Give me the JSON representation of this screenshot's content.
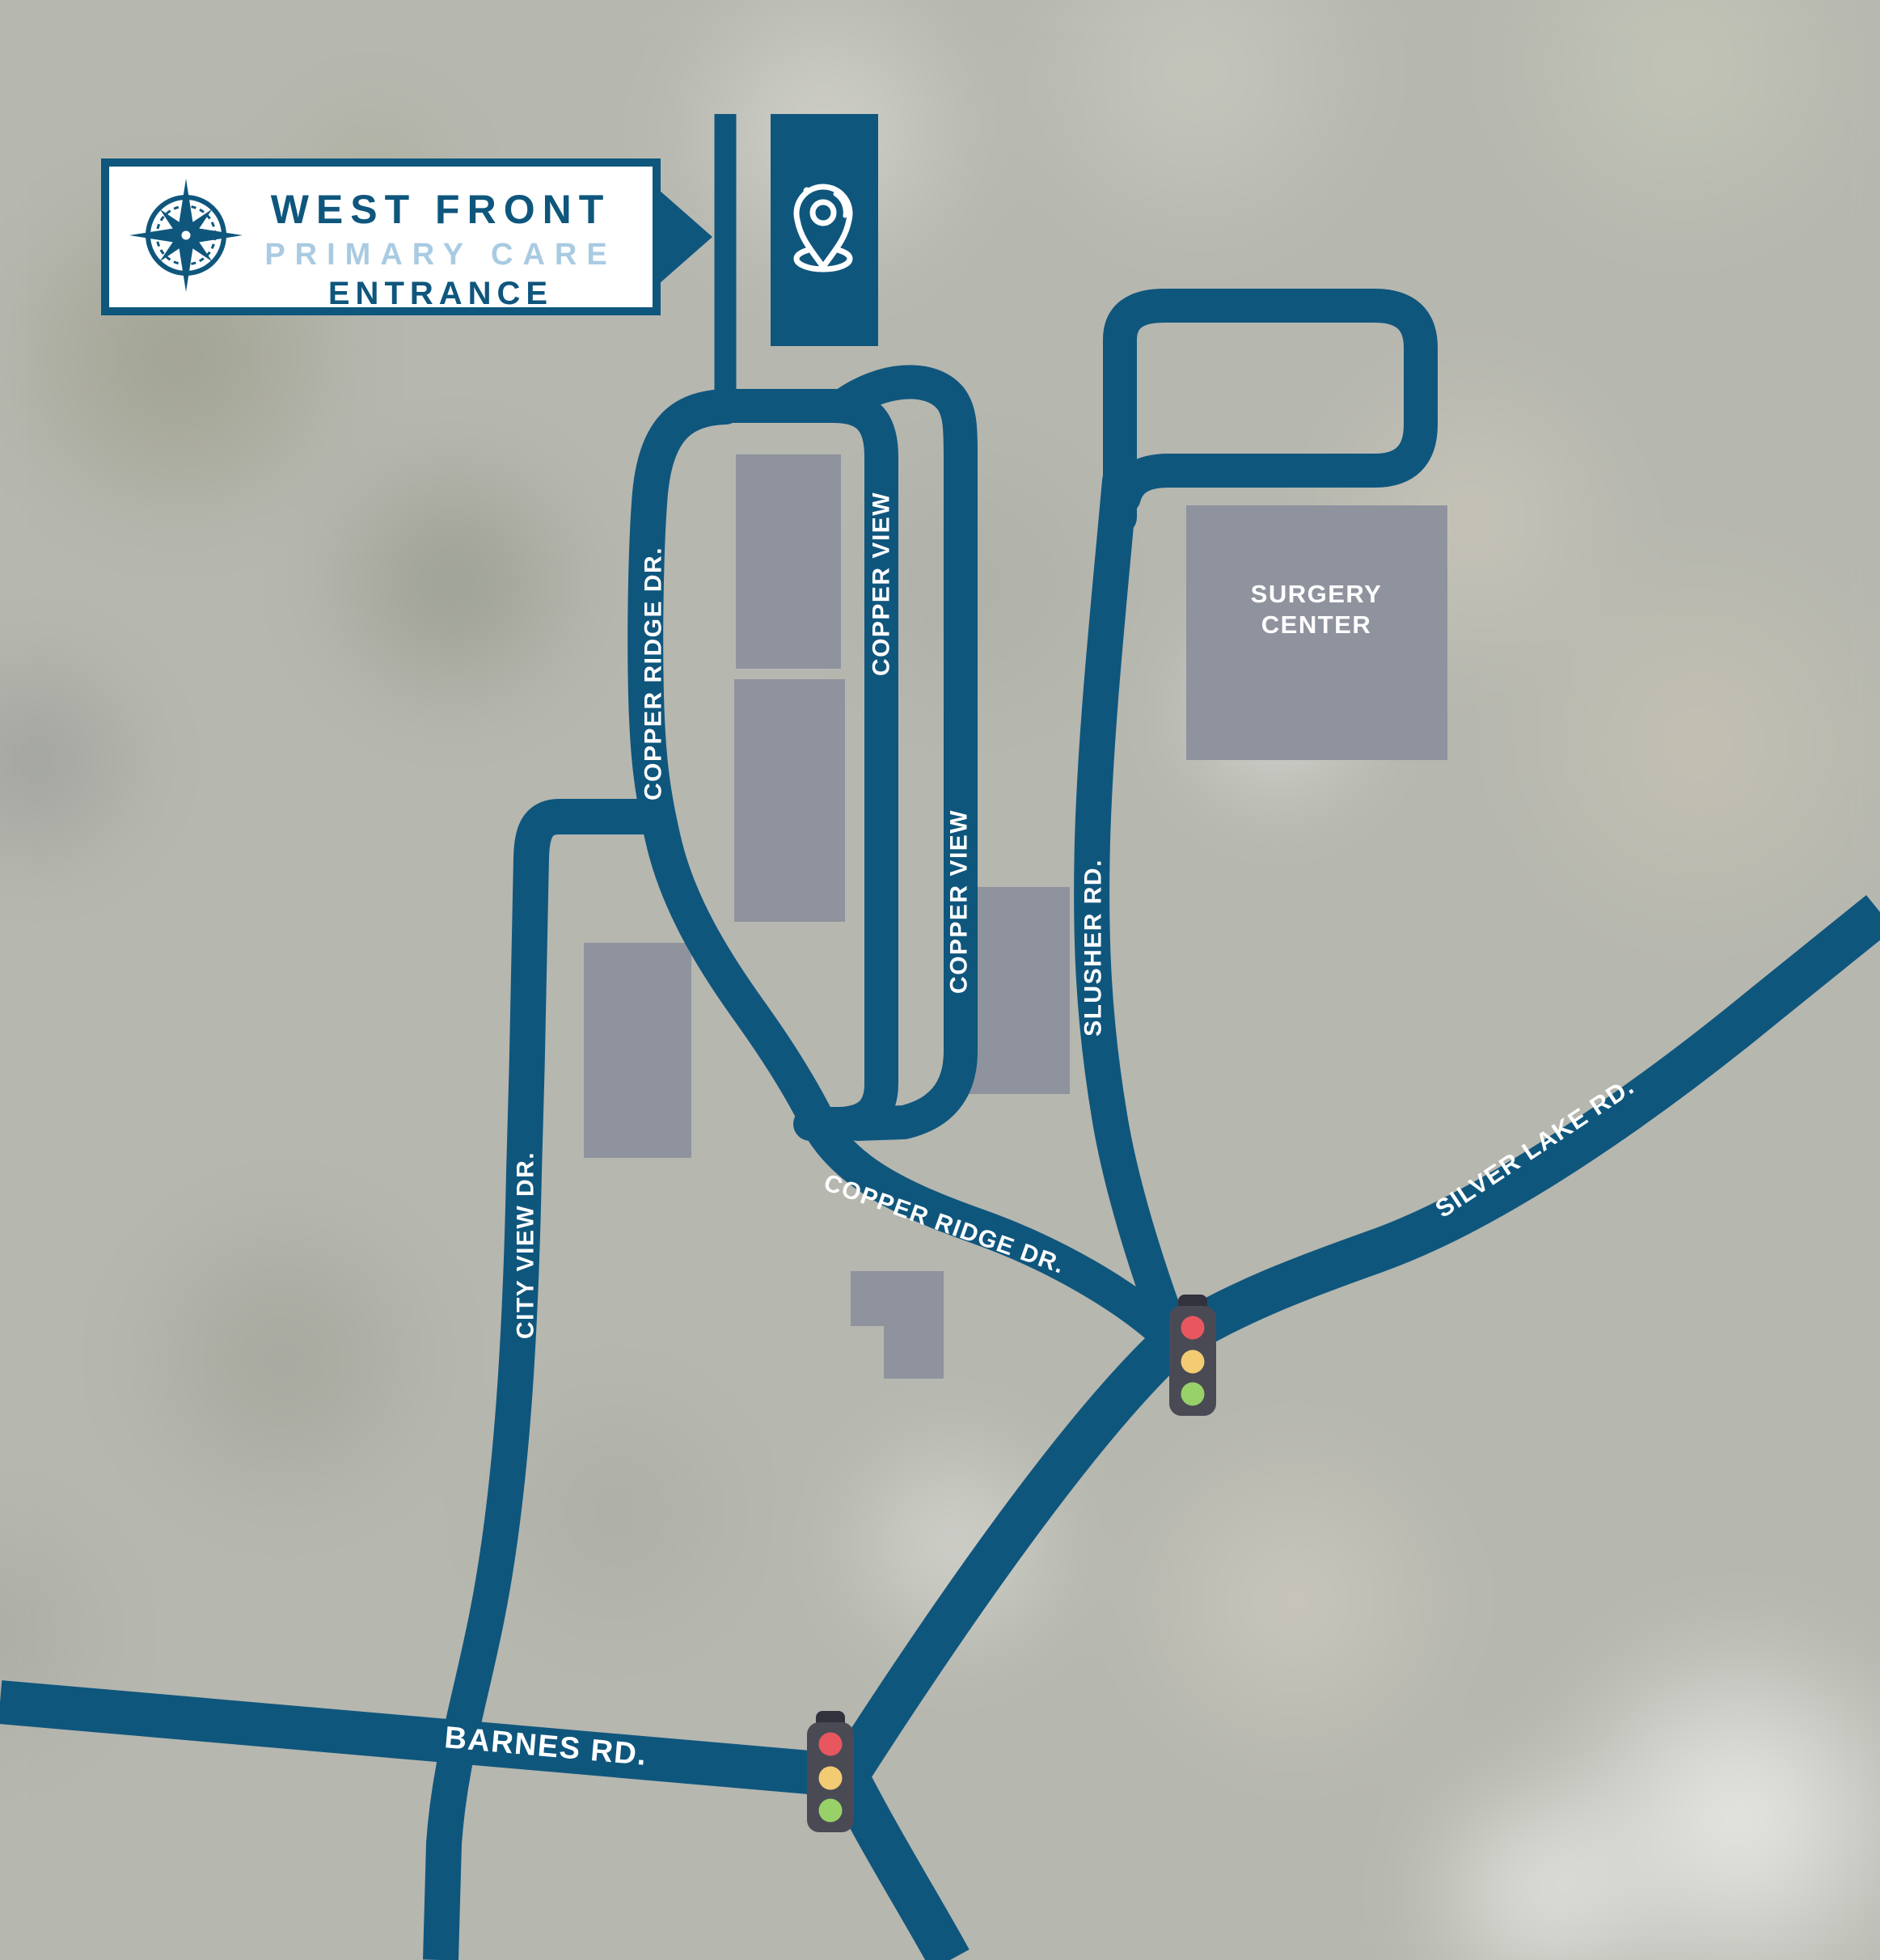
{
  "sign": {
    "title": "WEST FRONT",
    "subtitle": "PRIMARY CARE",
    "entrance": "ENTRANCE"
  },
  "roads": {
    "copper_ridge_upper": "COPPER RIDGE DR.",
    "copper_view_upper": "COPPER VIEW",
    "copper_view_lower": "COPPER VIEW",
    "slusher": "SLUSHER RD.",
    "copper_ridge_lower": "COPPER RIDGE DR.",
    "silver_lake": "SILVER LAKE RD.",
    "city_view": "CITY VIEW DR.",
    "barnes": "BARNES RD."
  },
  "places": {
    "surgery_line1": "SURGERY",
    "surgery_line2": "CENTER"
  },
  "colors": {
    "road_blue": "#0f567d",
    "building_gray": "#8f939e",
    "sign_accent_blue": "#a9cbe2",
    "traffic_red": "#e8575f",
    "traffic_yellow": "#f3cb72",
    "traffic_green": "#98d168"
  }
}
